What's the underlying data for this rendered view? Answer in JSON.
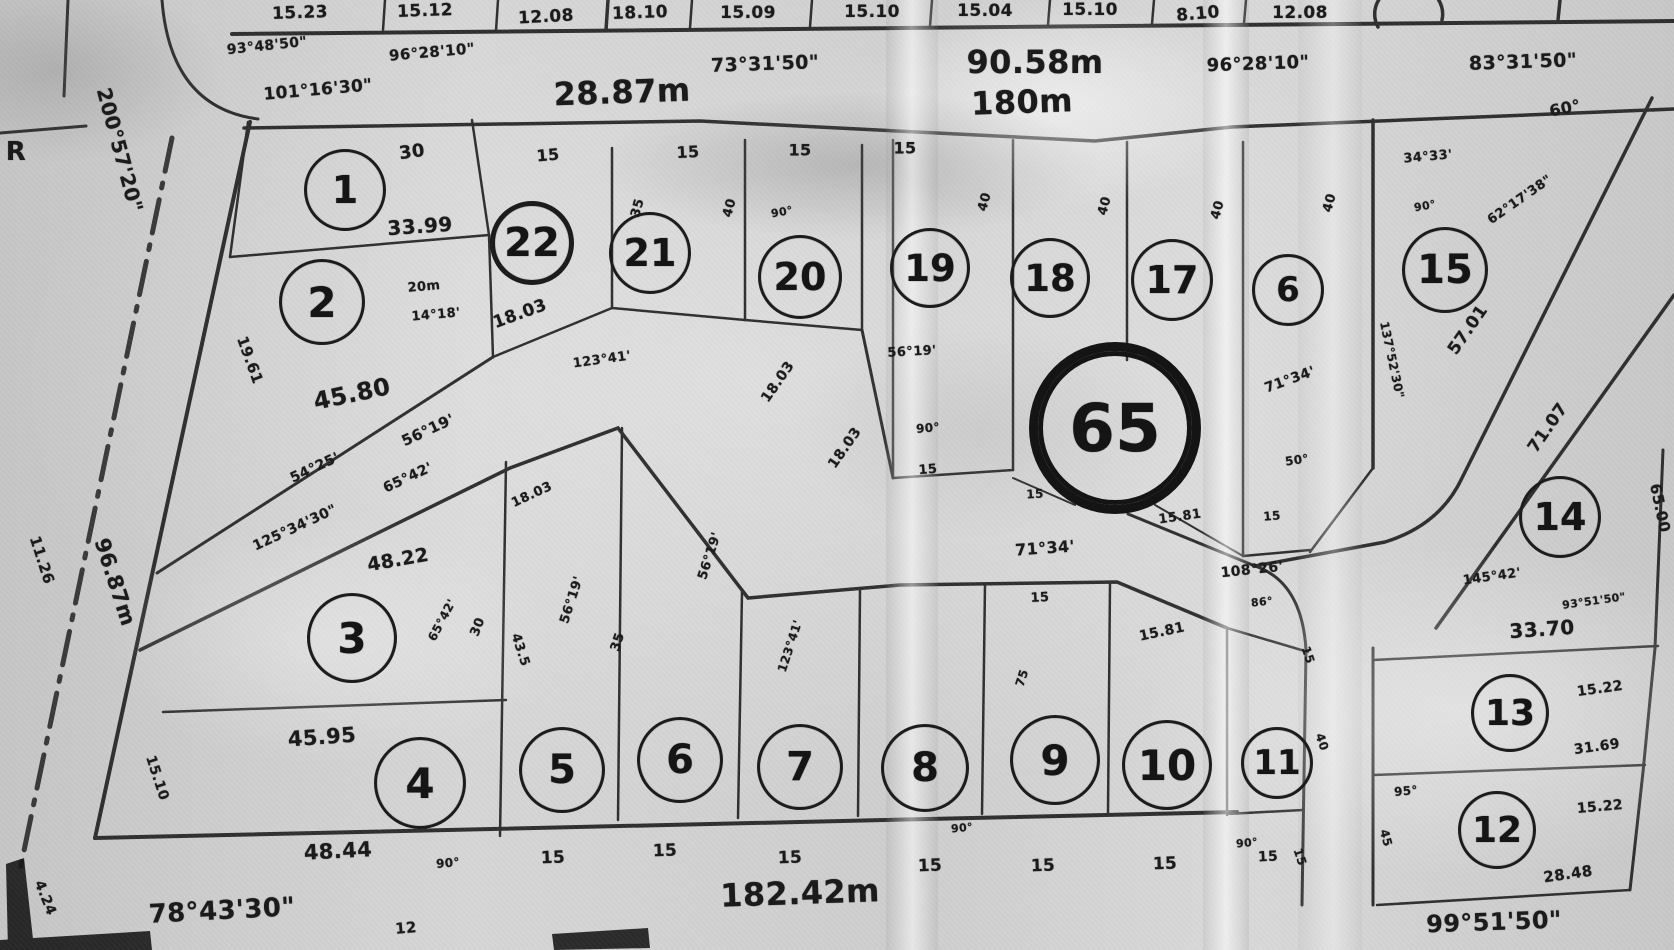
{
  "map": {
    "kind": "scanned hand-drawn cadastral subdivision plan",
    "colors": {
      "paper": "#d2d2d2",
      "ink": "#1b1b1b"
    },
    "lots": [
      "1",
      "2",
      "22",
      "21",
      "20",
      "19",
      "18",
      "17",
      "6",
      "15",
      "65",
      "3",
      "4",
      "5",
      "6",
      "7",
      "8",
      "9",
      "10",
      "11",
      "14",
      "13",
      "12"
    ],
    "labels": [
      "15.23",
      "15.12",
      "12.08",
      "18.10",
      "15.09",
      "15.10",
      "15.04",
      "15.10",
      "8.10",
      "12.08",
      "93°48'50\"",
      "96°28'10\"",
      "73°31'50\"",
      "90.58m",
      "96°28'10\"",
      "83°31'50\"",
      "101°16'30\"",
      "28.87m",
      "180m",
      "60°",
      "200°57'20\"",
      "R",
      "11.26",
      "96.87m",
      "15.10",
      "4.24",
      "30",
      "33.99",
      "20m",
      "14°18'",
      "45.80",
      "19.61",
      "56°19'",
      "54°25'",
      "65°42'",
      "125°34'30\"",
      "15",
      "15",
      "15",
      "15",
      "123°41'",
      "18.03",
      "35",
      "40",
      "90°",
      "40",
      "40",
      "40",
      "40",
      "90°",
      "18.03",
      "18.03",
      "56°19'",
      "90°",
      "15",
      "15",
      "71°34'",
      "50°",
      "15",
      "15.81",
      "34°33'",
      "62°17'38\"",
      "57.01",
      "137°52'30\"",
      "71.07",
      "71°34'",
      "108°26'",
      "86°",
      "15",
      "15.81",
      "48.22",
      "65°42'",
      "30",
      "43.5",
      "18.03",
      "45.95",
      "48.44",
      "90°",
      "78°43'30\"",
      "12",
      "56°19'",
      "35",
      "56°19'",
      "123°41'",
      "75",
      "15",
      "15",
      "15",
      "90°",
      "15",
      "15",
      "15",
      "90°",
      "15",
      "182.42m",
      "15",
      "40",
      "15",
      "65.00",
      "145°42'",
      "93°51'50\"",
      "33.70",
      "15.22",
      "31.69",
      "95°",
      "45",
      "15.22",
      "28.48",
      "99°51'50\""
    ]
  }
}
